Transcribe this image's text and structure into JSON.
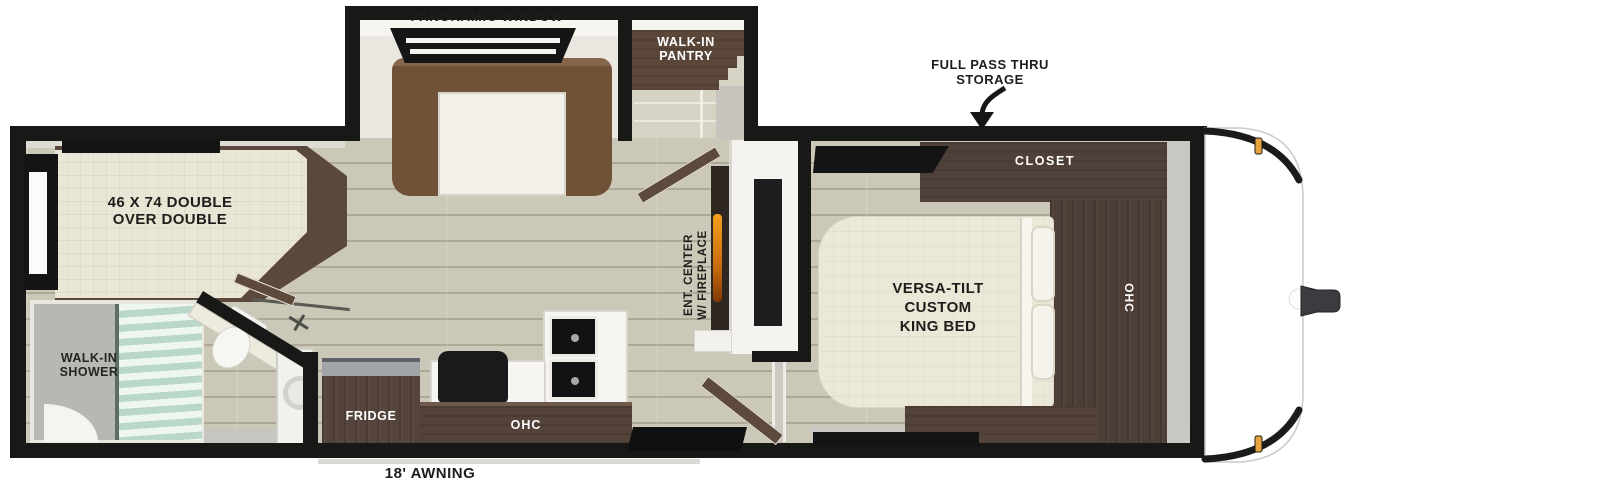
{
  "title": "Travel trailer floor plan",
  "labels": {
    "panoramic_window": "PANORAMIC WINDOW",
    "walk_in_pantry": "WALK-IN\nPANTRY",
    "full_pass_thru_storage": "FULL PASS THRU\nSTORAGE",
    "bunk_bed": "46 X 74 DOUBLE\nOVER DOUBLE",
    "walk_in_shower": "WALK-IN\nSHOWER",
    "king_bed": "VERSA-TILT\nCUSTOM\nKING BED",
    "closet": "CLOSET",
    "bedroom_ohc": "OHC",
    "kitchen_ohc": "OHC",
    "fridge": "FRIDGE",
    "ent_center": "ENT. CENTER\nW/ FIREPLACE",
    "awning": "18' AWNING"
  },
  "colors": {
    "wall": "#181816",
    "floor": "#ccc8b7",
    "cabinet_brown": "#54443b",
    "sofa_brown": "#6f5138",
    "bed_cream": "#ece8d8",
    "shower_glass": "#b9d8c9",
    "fireplace_flame": "#f7a01e",
    "marker_light": "#e8a33c",
    "label_text": "#1d1d1b"
  }
}
